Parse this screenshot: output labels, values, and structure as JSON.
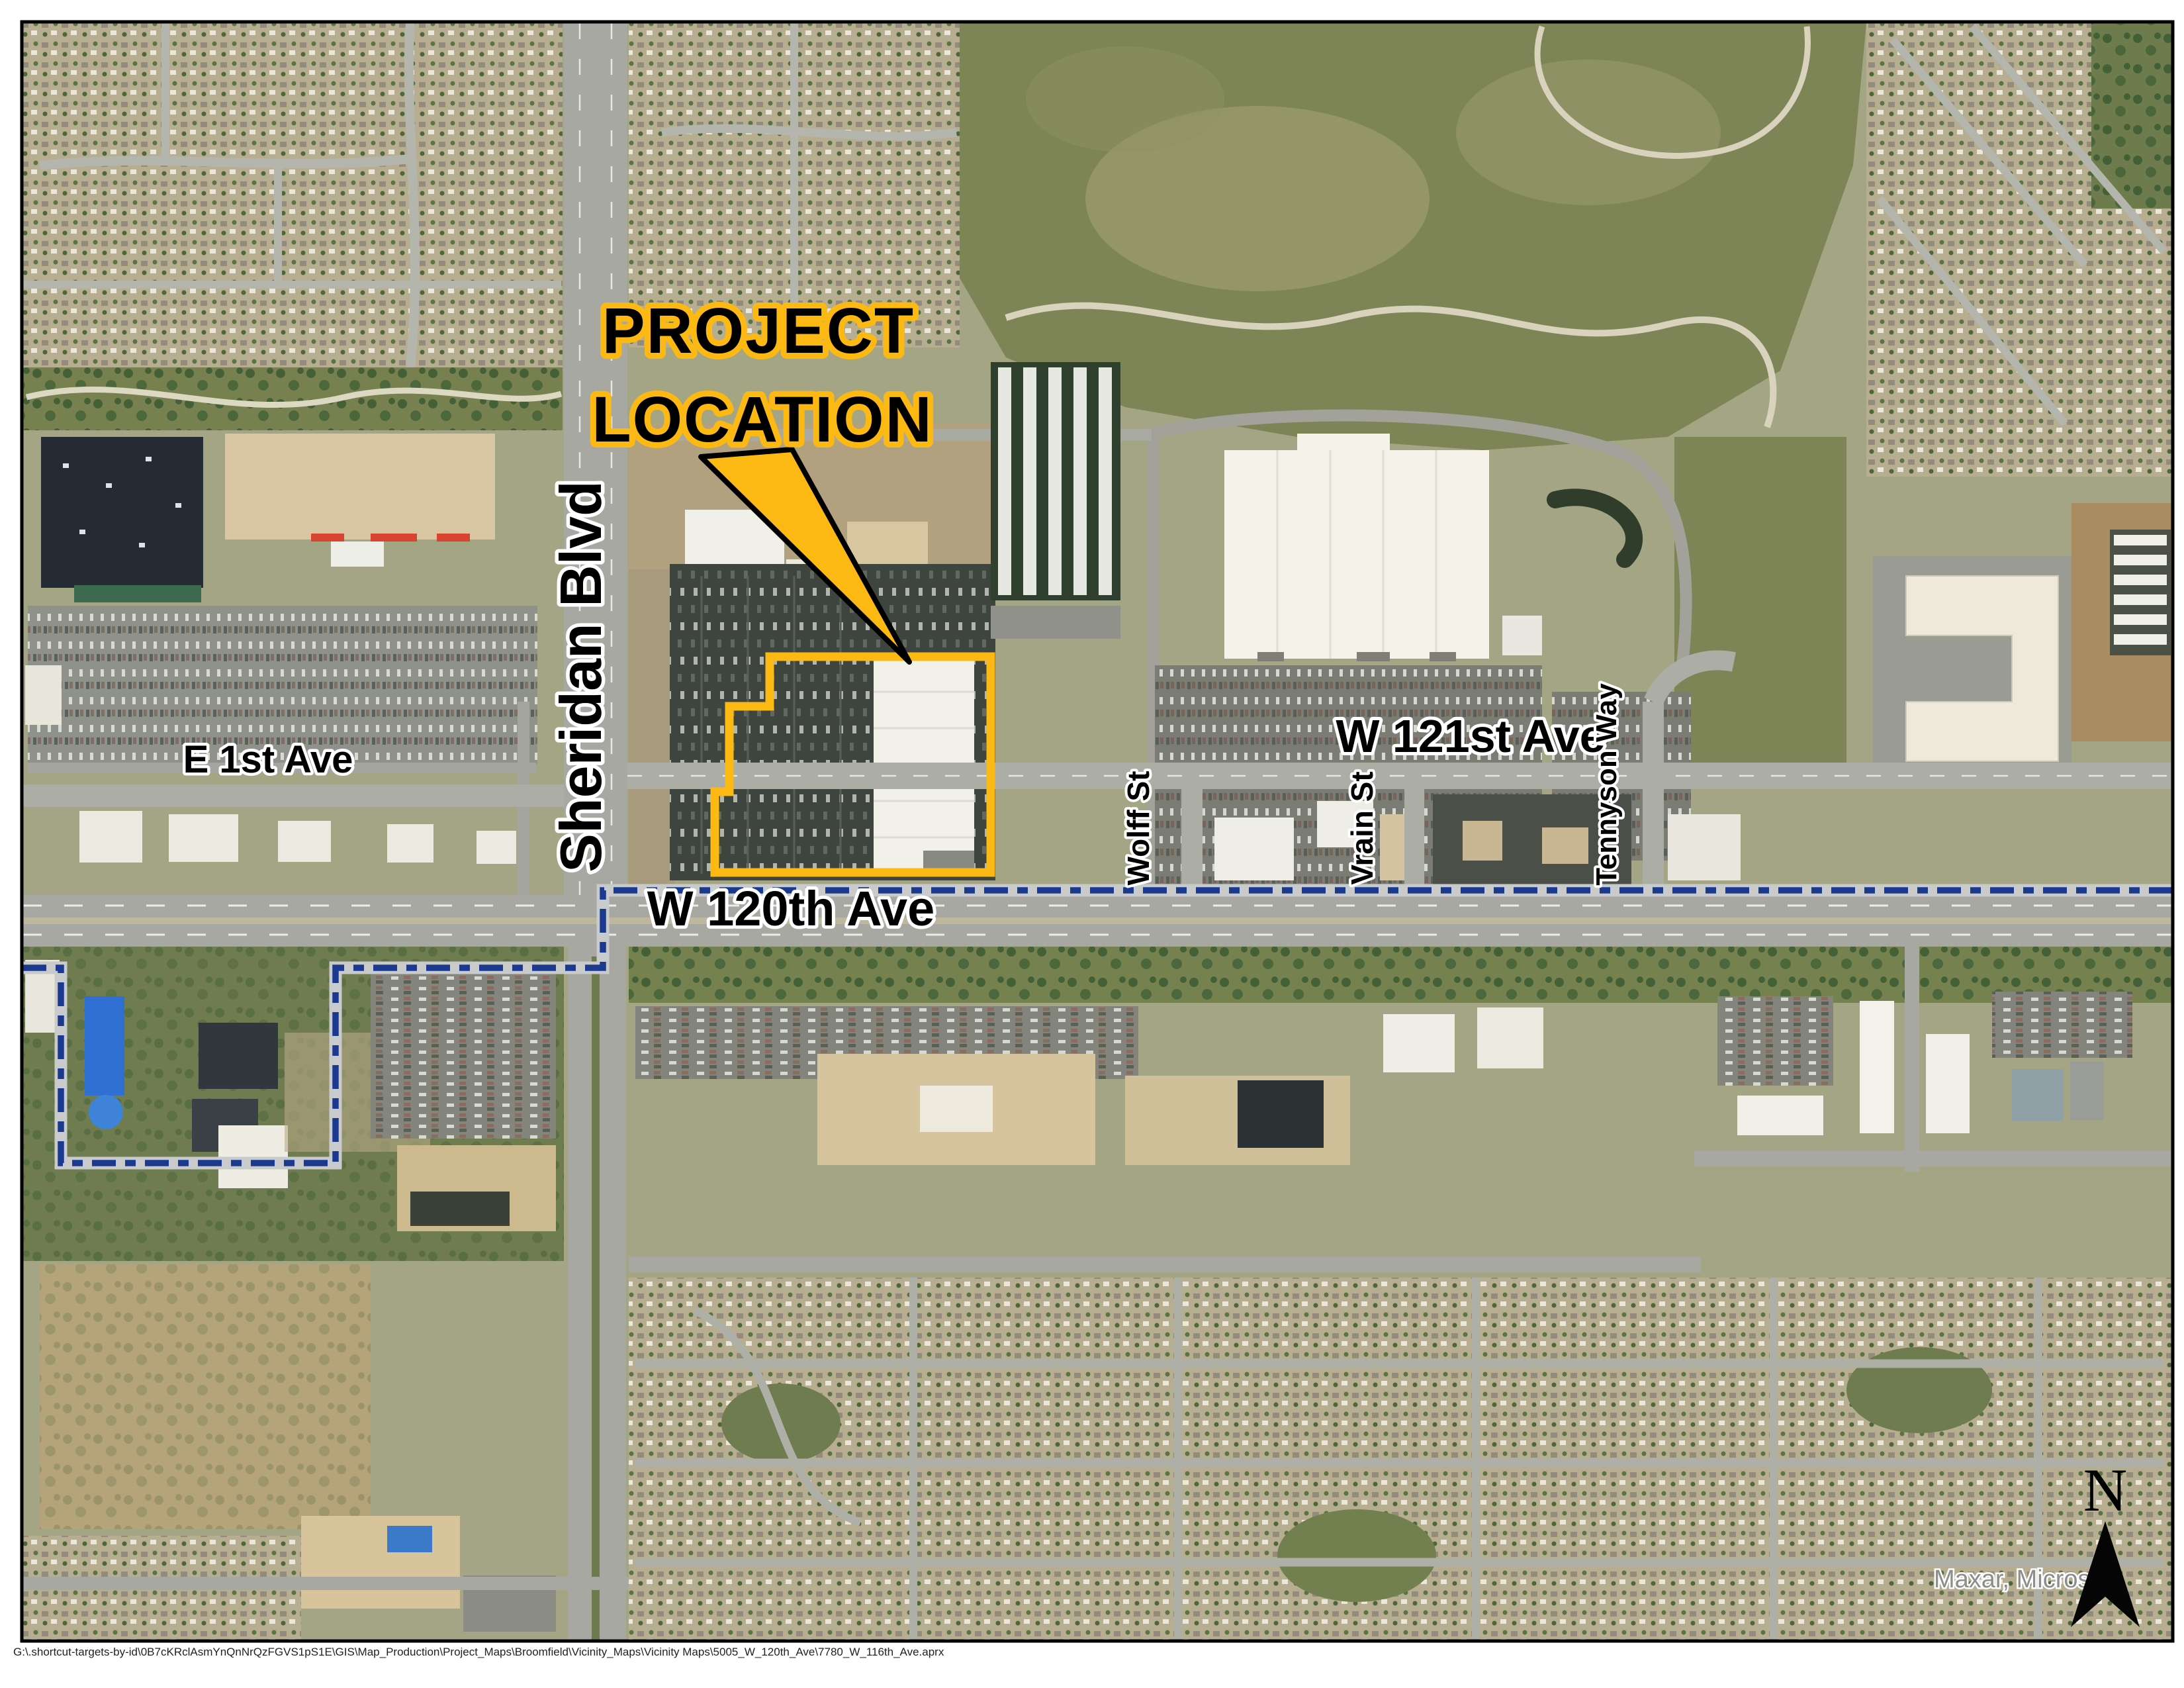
{
  "map": {
    "annotations": {
      "project_label_line1": "PROJECT",
      "project_label_line2": "LOCATION"
    },
    "streets": {
      "sheridan": "Sheridan Blvd",
      "e1st": "E 1st Ave",
      "w120th": "W 120th Ave",
      "w121st": "W 121st Ave",
      "wolff": "Wolff St",
      "vrain": "Vrain St",
      "tennyson": "Tennyson Way"
    },
    "north_label": "N",
    "attribution": "Maxar, Microsoft",
    "colors": {
      "highlight_yellow": "#FDB913",
      "boundary_blue": "#1B3A8F",
      "boundary_casing": "#C8CACC"
    }
  },
  "footer": {
    "file_path": "G:\\.shortcut-targets-by-id\\0B7cKRclAsmYnQnNrQzFGVS1pS1E\\GIS\\Map_Production\\Project_Maps\\Broomfield\\Vicinity_Maps\\Vicinity Maps\\5005_W_120th_Ave\\7780_W_116th_Ave.aprx"
  }
}
